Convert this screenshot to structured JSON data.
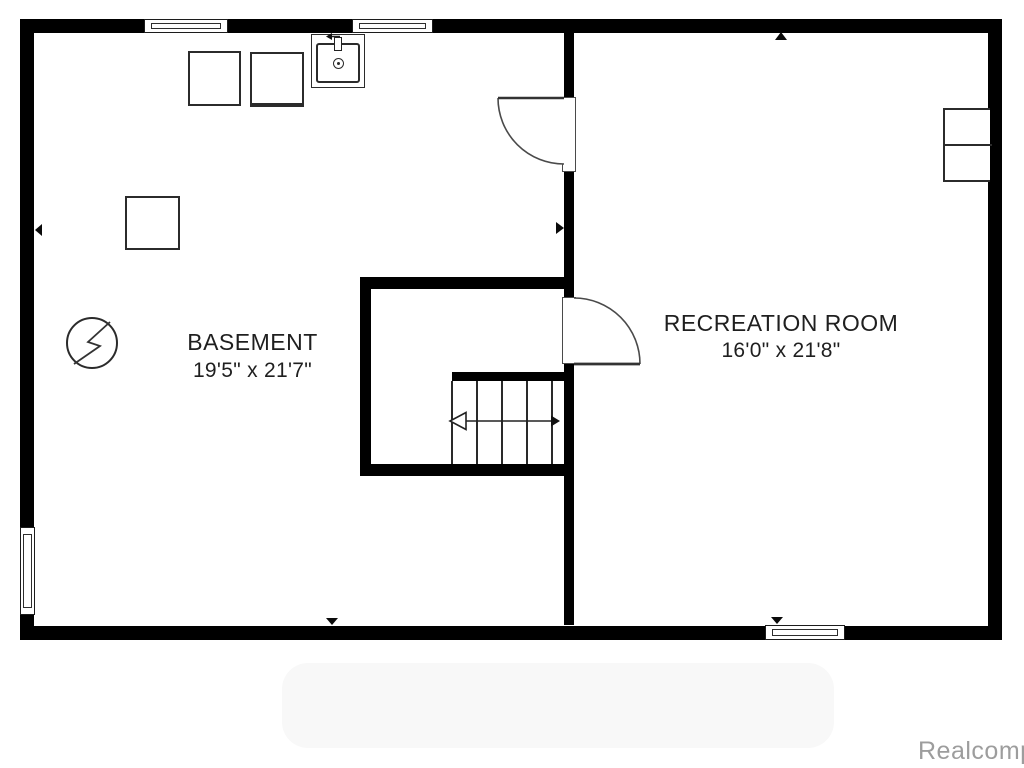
{
  "plan": {
    "type": "basement-floor-plan",
    "rooms": {
      "basement": {
        "name": "BASEMENT",
        "dimensions": "19'5\" x 21'7\""
      },
      "recreation": {
        "name": "RECREATION ROOM",
        "dimensions": "16'0\" x 21'8\""
      }
    },
    "fixtures": [
      "washer-box",
      "dryer-box",
      "laundry-sink-icon",
      "furnace-box",
      "electrical-panel-icon",
      "shelving-unit",
      "staircase",
      "stair-direction-arrow",
      "door-basement-swing",
      "door-recreation-swing",
      "window-top-left",
      "window-top-middle",
      "window-left",
      "window-bottom-right"
    ],
    "markers": [
      "up",
      "down-basement",
      "down-recreation",
      "left",
      "right"
    ]
  },
  "watermark": {
    "text": "Realcomp",
    "color": "#9d9d9d"
  },
  "colors": {
    "background": "#ffffff",
    "wall": "#000000",
    "fixture_line": "#2b2b2b",
    "text": "#1f1f1f",
    "watermark_blob": "#f8f8f8"
  }
}
